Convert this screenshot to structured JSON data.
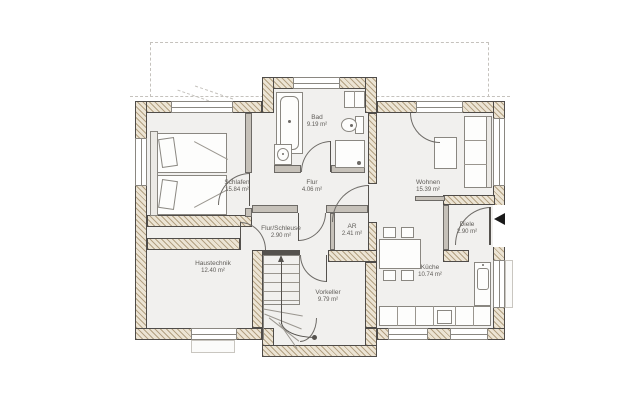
{
  "plan": {
    "type": "architectural-floor-plan",
    "rooms": [
      {
        "name": "Schlafen",
        "area": "15.84 m²"
      },
      {
        "name": "Bad",
        "area": "9.19 m²"
      },
      {
        "name": "Flur",
        "area": "4.06 m²"
      },
      {
        "name": "Wohnen",
        "area": "15.39 m²"
      },
      {
        "name": "Diele",
        "area": "2.90 m²"
      },
      {
        "name": "Flur/Schleuse",
        "area": "2.90 m²"
      },
      {
        "name": "AR",
        "area": "2.41 m²"
      },
      {
        "name": "Küche",
        "area": "10.74 m²"
      },
      {
        "name": "Haustechnik",
        "area": "12.40 m²"
      },
      {
        "name": "Vorkeller",
        "area": "9.79 m²"
      }
    ],
    "icons": {
      "entrance_arrow": "black left-pointing triangle at entrance door",
      "stair_arrow": "walk-line arrow pointing up the stairs"
    },
    "colors": {
      "wall_hatch": "#b3a183",
      "wall_base": "#ece4d4",
      "wall_outline": "#4f4c49",
      "interior_wall": "#c6c1b9",
      "floor": "#f1f0ee",
      "furniture_outline": "#8a8781",
      "text": "#5f5c58",
      "dashed_lines": "#c5c2bd",
      "entrance_arrow": "#1a1a1a"
    }
  }
}
